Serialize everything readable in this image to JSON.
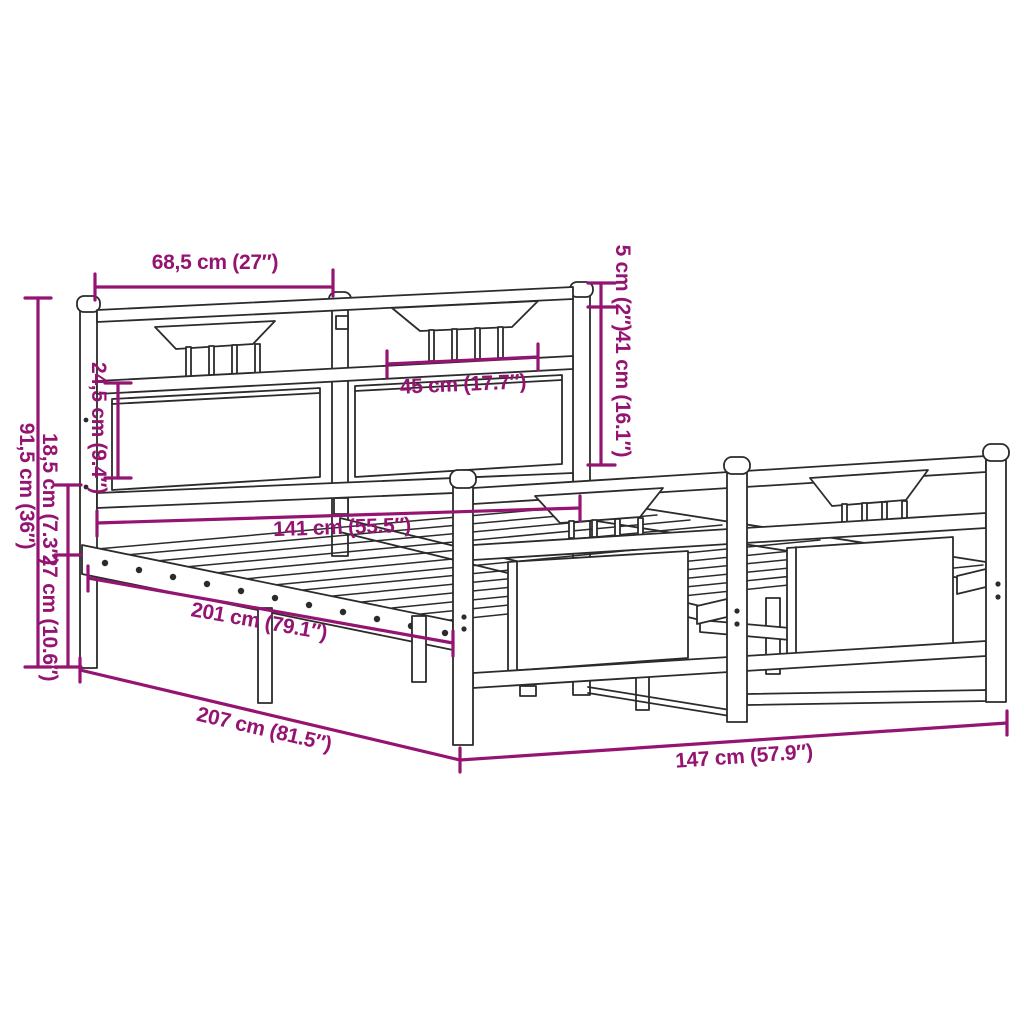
{
  "diagram": {
    "type": "product-dimension-diagram",
    "subject": "metal bed frame with headboard and footboard, slatted base",
    "units": [
      "cm",
      "inches"
    ],
    "colors": {
      "dimension_accent": "#951472",
      "drawing_line": "#2b2b2b",
      "background": "#ffffff"
    },
    "dimensions": [
      {
        "id": "headboard-section-width",
        "label": "68,5 cm (27″)"
      },
      {
        "id": "post-cap-offset",
        "label": "5 cm (2″)"
      },
      {
        "id": "headboard-drop-height",
        "label": "41 cm (16.1″)"
      },
      {
        "id": "panel-section-width",
        "label": "45 cm (17.7″)"
      },
      {
        "id": "headboard-panel-height",
        "label": "24,5 cm (9.4″)"
      },
      {
        "id": "headboard-total-height",
        "label": "91,5 cm (36″)"
      },
      {
        "id": "rail-to-floor-upper",
        "label": "18,5 cm (7.3″)"
      },
      {
        "id": "under-bed-clearance",
        "label": "27 cm (10.6″)"
      },
      {
        "id": "slat-surface-width",
        "label": "141 cm (55.5″)"
      },
      {
        "id": "slat-surface-length",
        "label": "201 cm (79.1″)"
      },
      {
        "id": "frame-outer-length",
        "label": "207 cm (81.5″)"
      },
      {
        "id": "frame-outer-width",
        "label": "147 cm (57.9″)"
      }
    ]
  }
}
